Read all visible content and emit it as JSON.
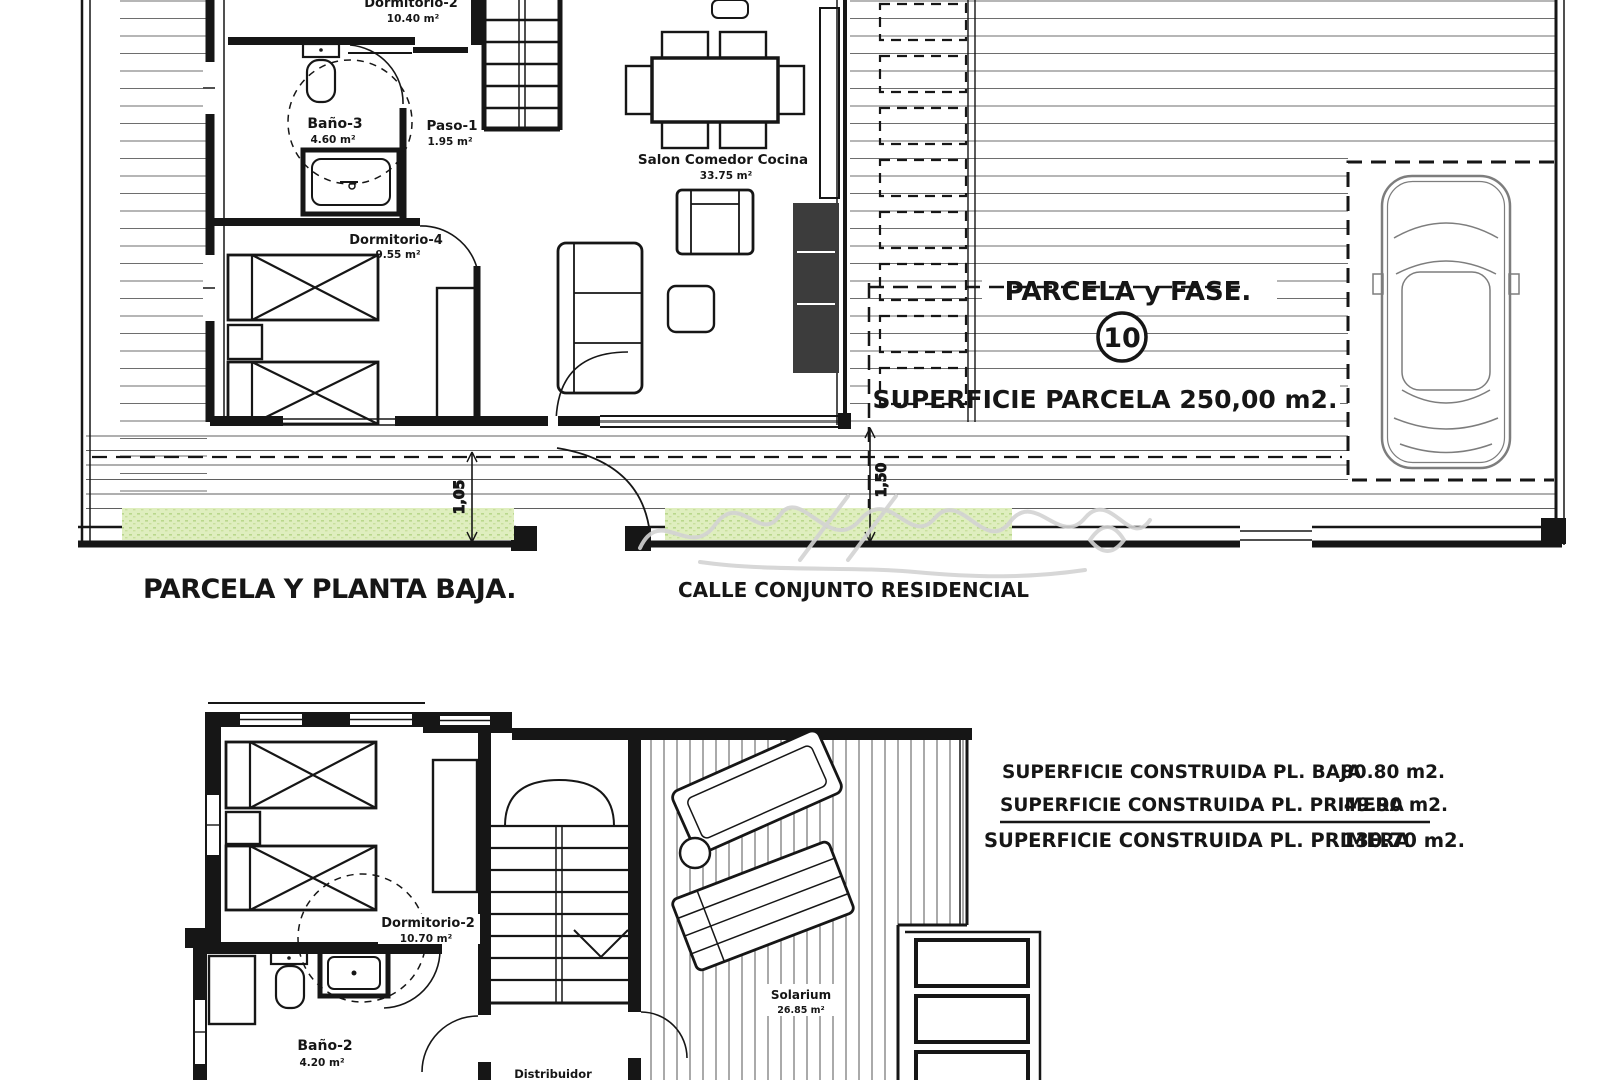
{
  "ground_floor": {
    "caption": "PARCELA Y PLANTA BAJA.",
    "street_label": "CALLE CONJUNTO RESIDENCIAL",
    "rooms": [
      {
        "name": "Dormitorio-2",
        "area": "10.40 m²"
      },
      {
        "name": "Baño-3",
        "area": "4.60 m²"
      },
      {
        "name": "Paso-1",
        "area": "1.95 m²"
      },
      {
        "name": "Dormitorio-4",
        "area": "9.55 m²"
      },
      {
        "name": "Salon Comedor Cocina",
        "area": "33.75 m²"
      }
    ],
    "parcel": {
      "title": "PARCELA y FASE.",
      "number": "10",
      "surface_label": "SUPERFICIE PARCELA 250,00 m2."
    },
    "dimensions": [
      {
        "value": "1,05"
      },
      {
        "value": "1,50"
      }
    ]
  },
  "first_floor": {
    "rooms": [
      {
        "name": "Dormitorio-2",
        "area": "10.70 m²"
      },
      {
        "name": "Baño-2",
        "area": "4.20 m²"
      },
      {
        "name": "Distribuidor",
        "area": ""
      },
      {
        "name": "Solarium",
        "area": "26.85 m²"
      }
    ],
    "areas_table": {
      "rows": [
        {
          "label": "SUPERFICIE CONSTRUIDA PL. BAJA",
          "value": "80.80 m2."
        },
        {
          "label": "SUPERFICIE CONSTRUIDA PL. PRIMERA",
          "value": "49.90 m2."
        },
        {
          "label": "SUPERFICIE CONSTRUIDA PL. PRIMERA",
          "value": "130.70 m2."
        }
      ]
    }
  },
  "colors": {
    "ink": "#161616",
    "grass": "#dfeebf",
    "grass_dot": "#b9d78c",
    "car_line": "#7d7d7d",
    "watermark": "#d3d3d3"
  }
}
